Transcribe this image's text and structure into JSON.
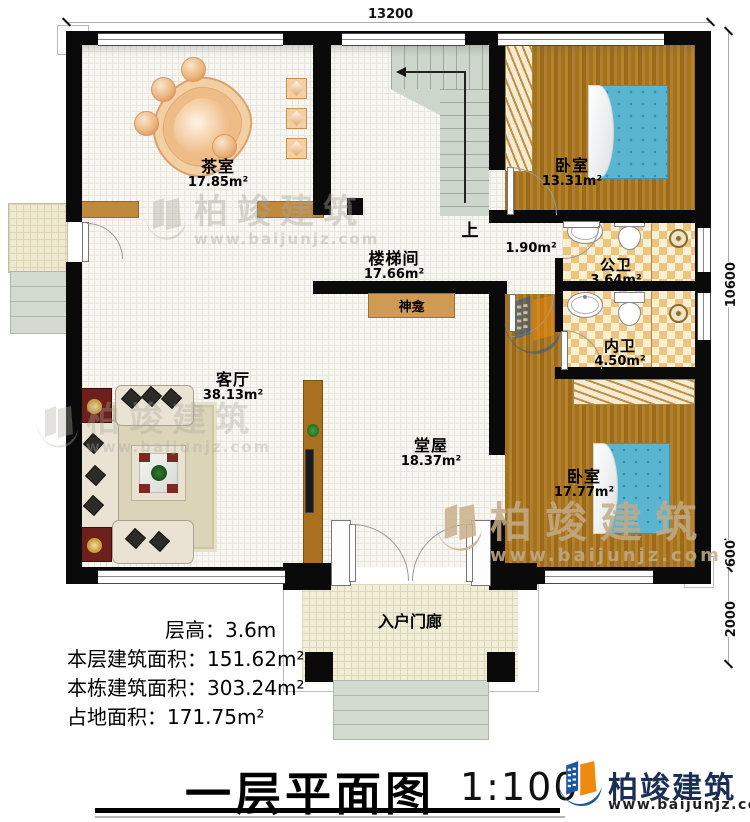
{
  "rooms": {
    "tea_room": {
      "name": "茶室",
      "area": "17.85m²"
    },
    "bedroom_top": {
      "name": "卧室",
      "area": "13.31m²"
    },
    "stair_hall": {
      "name": "楼梯间",
      "area": "17.66m²"
    },
    "stair_up": "上",
    "vestibule_area": "1.90m²",
    "public_bath": {
      "name": "公卫",
      "area": "3.64m²"
    },
    "private_bath": {
      "name": "内卫",
      "area": "4.50m²"
    },
    "living_room": {
      "name": "客厅",
      "area": "38.13m²"
    },
    "main_hall": {
      "name": "堂屋",
      "area": "18.37m²"
    },
    "bedroom_bottom": {
      "name": "卧室",
      "area": "17.77m²"
    },
    "entry_porch": "入户门廊",
    "shrine": "神龛"
  },
  "dimensions": {
    "width_top": "13200",
    "height_main": "10600",
    "height_step": "600",
    "height_porch": "2000"
  },
  "stats": {
    "floor_height": "层高：3.6m",
    "floor_area": "本层建筑面积：151.62m²",
    "building_area": "本栋建筑面积：303.24m²",
    "footprint_area": "占地面积：171.75m²"
  },
  "footer": {
    "title": "一层平面图",
    "scale": "1:100",
    "brand": "柏竣建筑",
    "website": "www.baijunjz.com"
  },
  "watermark": {
    "brand": "柏竣建筑",
    "website": "www.baijunjz.com"
  },
  "colors": {
    "wall": "#0a0a0a",
    "wood_floor": "#a9761f",
    "bed": "#5ab6d0",
    "brand_blue": "#1e56a0",
    "brand_orange": "#ef8a11",
    "brand_navy": "#1b2f56"
  }
}
